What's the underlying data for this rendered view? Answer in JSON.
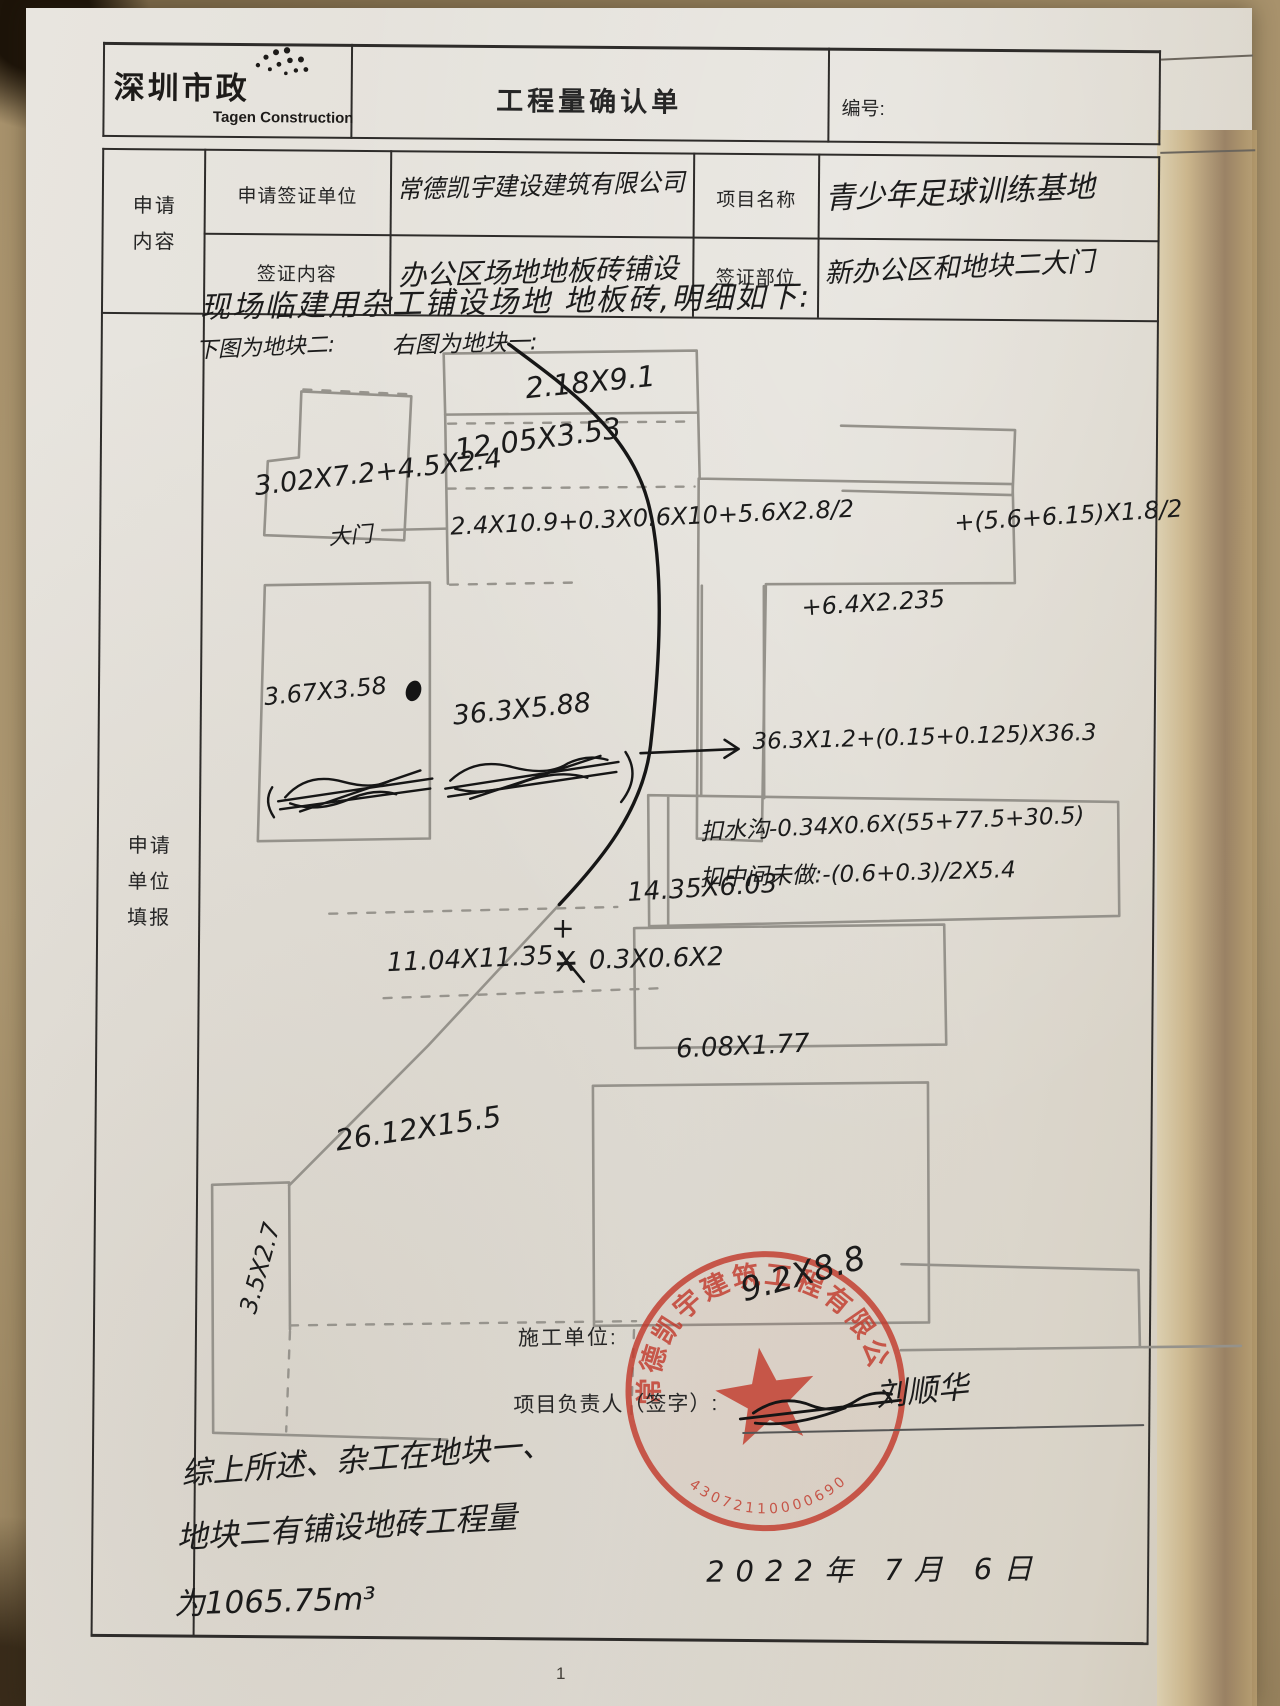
{
  "colors": {
    "stamp_red": "#c23a2c",
    "ink": "#1b1b1b",
    "pencil": "#95928b",
    "paper": "#e3e0da",
    "background_tan": "#a8926c",
    "table_line": "#2e2c2a"
  },
  "header": {
    "logo_cn": "深圳市政",
    "logo_en": "Tagen Construction",
    "title": "工程量确认单",
    "number_label": "编号:"
  },
  "form": {
    "left_label_line1": "申请",
    "left_label_line2": "内容",
    "row1": {
      "label": "申请签证单位",
      "value": "常德凯宇建设建筑有限公司",
      "label2": "项目名称",
      "value2": "青少年足球训练基地"
    },
    "row2": {
      "label": "签证内容",
      "value": "办公区场地地板砖铺设",
      "label2": "签证部位",
      "value2": "新办公区和地块二大门"
    },
    "section_label_line1": "申请",
    "section_label_line2": "单位",
    "section_label_line3": "填报"
  },
  "sketch": {
    "intro_line1": "现场临建用杂工铺设场地 地板砖,明细如下:",
    "legend_left": "下图为地块二:",
    "legend_right": "右图为地块一:",
    "plot_a_dims": "3.02X7.2+4.5X2.4",
    "gate_label": "大门",
    "plot_b_dims": "3.67X3.58",
    "dim_top_rect": "2.18X9.1",
    "dim_second": "12.05X3.53",
    "formula_main": "2.4X10.9+0.3X0.6X10+5.6X2.8/2",
    "formula_main_b": "+(5.6+6.15)X1.8/2",
    "formula_main_c": "+6.4X2.235",
    "dim_long_strip": "36.3X5.88",
    "formula_arrow": "36.3X1.2+(0.15+0.125)X36.3",
    "deduction_gutter": "扣水沟-0.34X0.6X(55+77.5+30.5)",
    "deduction_middle": "扣中间未做:-(0.6+0.3)/2X5.4",
    "dim_mid_rect": "14.35X6.03",
    "formula_lower_a": "11.04X11.35",
    "formula_lower_struck": "X",
    "formula_lower_plus": "+",
    "formula_lower_b": "0.3X0.6X2",
    "dim_small_rect": "6.08X1.77",
    "dim_large_area": "26.12X15.5",
    "dim_left_small": "3.5X2.7",
    "dim_stamp_area": "9.2X8.8"
  },
  "footer": {
    "summary_line1": "综上所述、杂工在地块一、",
    "summary_line2": "地块二有铺设地砖工程量",
    "summary_line3": "为1065.75m³",
    "contractor_label": "施工单位:",
    "manager_label": "项目负责人（签字）:",
    "signature": "刘顺华",
    "date": "2022年 7月 6日",
    "page_number": "1",
    "stamp_company": "常德凯宇建筑工程有限公司",
    "stamp_number": "43072110000690"
  }
}
